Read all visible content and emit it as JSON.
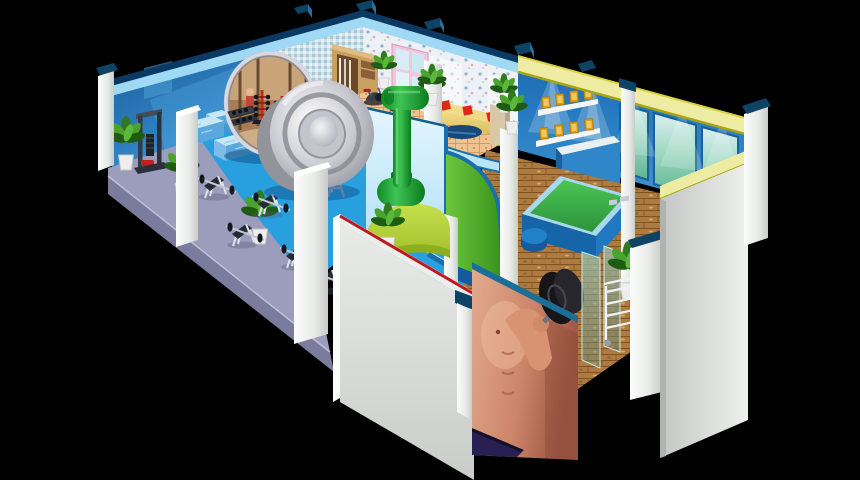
{
  "meta": {
    "title": "Fitness club — isometric 3D cutaway illustration",
    "canvas_width": 860,
    "canvas_height": 480,
    "style": "isometric architectural cutaway on black background",
    "visible_text": "none"
  },
  "palette": {
    "bg": "#000000",
    "bandNavy": "#0a3a64",
    "bandLight": "#9fd9f4",
    "yellowBand": "#eeeca2",
    "yellowEdgeDark": "#a8a414",
    "yellowEdgeLight": "#d6d242",
    "capTeal": "#0d4466",
    "capTealLight": "#2b6d97",
    "wallBlueDark": "#175490",
    "wallBlueLight": "#55b4e6",
    "mosaicBase": "#cfe2ea",
    "wallpaperBase": "#edf1f5",
    "trophyWallBlue": "#1a6cb4",
    "windowGlowGreen": "#62b888",
    "floorLavender": "#9c9cbc",
    "floorLavenderSide": "#7b7b9d",
    "floorBlue": "#28a0e0",
    "floorBlueLight": "#2b9ade",
    "floorTile": "#efc292",
    "parquetWood": "#ad7a41",
    "matGreen": "#3cb84c",
    "matRim": "#a8d8ee",
    "matSide": "#1f78c0",
    "matSideDark": "#1565a8",
    "pouf": "#2080c8",
    "trimBlue": "#1a6faa",
    "receptionPaleBlue": "#cceefc",
    "receptionGreen": "#58b832",
    "receptionBaseBlue": "#155a9c",
    "limeCounter": "#b8d838",
    "limeCounterDark": "#8fae1e",
    "statueGreen": "#1ea038",
    "statueGreenDark": "#0c7a1e",
    "silverLight": "#eeeef2",
    "silverDark": "#8e8e98",
    "pillarWhite": "#f4f6f4",
    "grayWall": "#d2d6d2",
    "redTrim": "#c01820",
    "skinTone": "#d89078",
    "shortsNavy": "#282052",
    "muralEdgeTeal": "#1b6f95",
    "sofaYellow": "#e8d070",
    "pillowRed": "#e02818",
    "tableNavy": "#184878",
    "plantGreen": "#3a8828",
    "potWhite": "#eeeeee",
    "cabinetWood": "#c8a060",
    "gold": "#d8a018",
    "goldLight": "#f0c860",
    "shelfWhite": "#f4f6f8",
    "counterBlue": "#2f86c8",
    "glassPanel": "#8cb4a0",
    "benchSeat": "#252b33",
    "frameWhite": "#e8ecf2",
    "rackRed": "#c62818"
  },
  "scene": {
    "background_color": "#000000",
    "areas": [
      {
        "id": "weights-area",
        "label": "Free-weights area with bench press stations",
        "floor": "lavender"
      },
      {
        "id": "main-floor",
        "label": "Main gym floor",
        "floor": "bright blue"
      },
      {
        "id": "cardio-area",
        "label": "Cardio corner with exercise bikes",
        "floor": "peach tile"
      },
      {
        "id": "lounge",
        "label": "Lounge with yellow sofa and red pillows",
        "floor": "wood"
      },
      {
        "id": "reception",
        "label": "Curved reception with green dumbbell statue"
      },
      {
        "id": "trophy-room",
        "label": "Trophy wall with lit certificate shelves",
        "floor": "parquet"
      },
      {
        "id": "mat-room",
        "label": "Exercise-mat platform room",
        "floor": "parquet"
      },
      {
        "id": "entrance-lobby",
        "label": "Entrance lobby with athlete mural and glass partitions",
        "floor": "parquet"
      }
    ],
    "objects": [
      {
        "id": "back-wall-left",
        "label": "Blue back wall with top trim band"
      },
      {
        "id": "mosaic-wall",
        "label": "Blue mosaic tiled wall section"
      },
      {
        "id": "wallpaper-wall",
        "label": "Floral wallpaper wall with pink window and lace curtains"
      },
      {
        "id": "wardrobe",
        "label": "Open wooden wardrobe with clothes"
      },
      {
        "id": "trophy-wall",
        "label": "Blue wall with two white shelves of gold certificates and spotlights"
      },
      {
        "id": "frosted-windows",
        "label": "Three frosted glowing window panels"
      },
      {
        "id": "display-counter",
        "label": "Blue display counter under trophy shelves"
      },
      {
        "id": "wall-mirror",
        "label": "Large oval leaning mirror reflecting gym scene"
      },
      {
        "id": "giant-weight-plate",
        "label": "Giant silver barbell plate sculpture"
      },
      {
        "id": "green-dumbbell-statue",
        "label": "Green dumbbell statue on lime counter"
      },
      {
        "id": "cable-machine",
        "label": "Cable pulldown machine with red seat"
      },
      {
        "id": "workout-benches",
        "label": "Five barbell workout benches"
      },
      {
        "id": "bench-blocks",
        "label": "Light blue upholstered bench blocks"
      },
      {
        "id": "squat-racks",
        "label": "Two chrome barbell stands"
      },
      {
        "id": "dumbbell-trees",
        "label": "Red dumbbell tree racks by the mirror"
      },
      {
        "id": "exercise-bikes",
        "label": "Exercise bikes on tiled cardio floor"
      },
      {
        "id": "lounge-sofa",
        "label": "Yellow corner sofa with three red pillows and navy table"
      },
      {
        "id": "exercise-mat",
        "label": "Green exercise mat platform with blue base"
      },
      {
        "id": "athlete-mural",
        "label": "Photo mural of athlete curling a black dumbbell"
      },
      {
        "id": "glass-partitions",
        "label": "Translucent entrance glass partitions"
      },
      {
        "id": "towel-cart",
        "label": "White wheeled shelf cart"
      },
      {
        "id": "plants",
        "label": "Potted green plants throughout"
      },
      {
        "id": "front-pillars",
        "label": "White cutaway pillars along front edge"
      },
      {
        "id": "front-wall-red-trim",
        "label": "Gray front wall with red trim line"
      },
      {
        "id": "right-end-wall",
        "label": "Gray end wall with yellow trim"
      }
    ]
  }
}
